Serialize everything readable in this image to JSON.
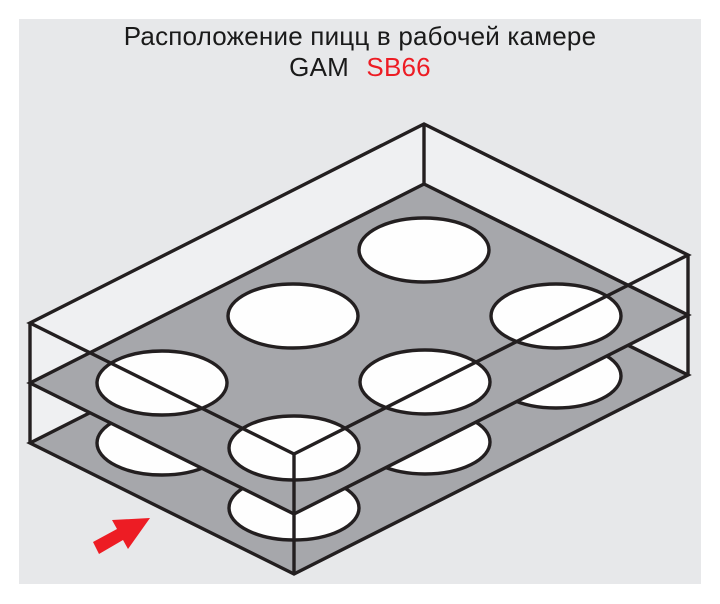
{
  "title": {
    "line1": "Расположение пицц в рабочей камере",
    "line2_model_prefix": "GAM",
    "line2_model_number": "SB66"
  },
  "colors": {
    "page": "#ffffff",
    "panel": "#e7e8ea",
    "box_inner": "#eff0f2",
    "tray": "#a6a7ab",
    "pizza": "#fefefe",
    "outline": "#231f20",
    "arrow": "#ed1c24",
    "accent": "#ed1c24",
    "text": "#1a1a1a"
  },
  "diagram": {
    "subject": "oven working chamber with two shelves of pizzas",
    "shelf_count": 2,
    "shelves": [
      {
        "name": "upper-shelf",
        "pizza_count": 6
      },
      {
        "name": "lower-shelf",
        "pizza_count": 6
      }
    ],
    "total_pizzas": 12
  }
}
